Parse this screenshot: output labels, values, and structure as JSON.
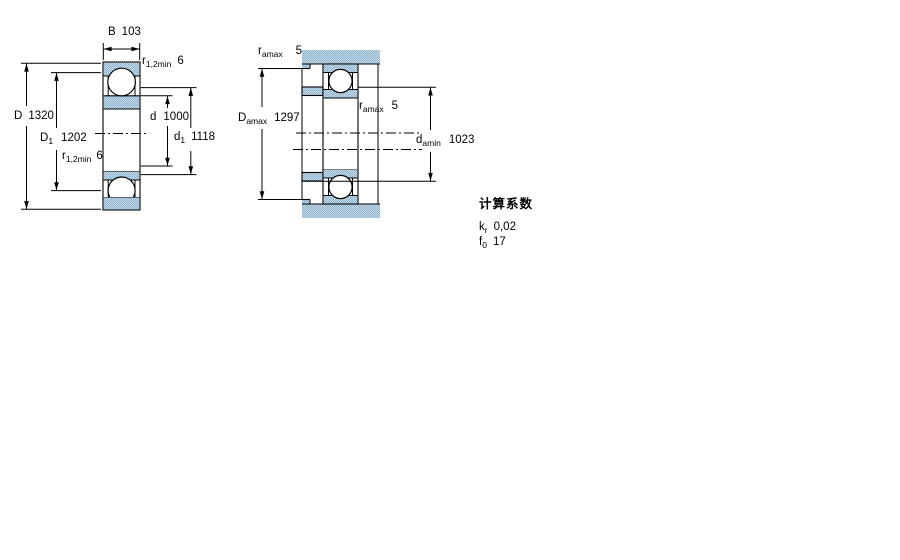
{
  "left_figure": {
    "B": {
      "pre": "B",
      "sub": "",
      "val": "103"
    },
    "r_top": {
      "pre": "r",
      "sub": "1,2min",
      "val": "6"
    },
    "D": {
      "pre": "D",
      "sub": "",
      "val": "1320"
    },
    "D1": {
      "pre": "D",
      "sub": "1",
      "val": "1202"
    },
    "r_bottom": {
      "pre": "r",
      "sub": "1,2min",
      "val": "6"
    },
    "d": {
      "pre": "d",
      "sub": "",
      "val": "1000"
    },
    "d1": {
      "pre": "d",
      "sub": "1",
      "val": "1118"
    }
  },
  "right_figure": {
    "r_a_top": {
      "pre": "r",
      "sub": "amax",
      "val": "5"
    },
    "D_a": {
      "pre": "D",
      "sub": "amax",
      "val": "1297"
    },
    "r_a_mid": {
      "pre": "r",
      "sub": "amax",
      "val": "5"
    },
    "d_a": {
      "pre": "d",
      "sub": "amin",
      "val": "1023"
    }
  },
  "calculation_factors": {
    "title": "计算系数",
    "k": {
      "pre": "k",
      "sub": "r",
      "val": "0,02"
    },
    "f": {
      "pre": "f",
      "sub": "0",
      "val": "17"
    }
  },
  "colors": {
    "line": "#000000",
    "hatch_base": "#c7dbea",
    "hatch_dot": "#8fb2cc"
  }
}
